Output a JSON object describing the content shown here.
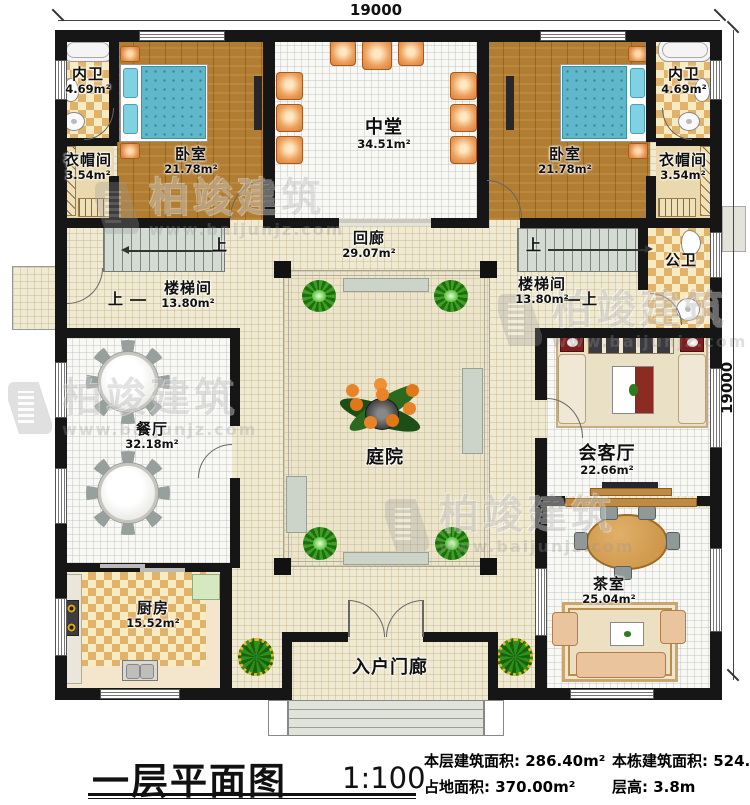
{
  "dimensions": {
    "top": "19000",
    "right": "19000"
  },
  "watermark": {
    "brand": "柏竣建筑",
    "url": "www.baijunjz.com"
  },
  "stairs": {
    "up_label": "上"
  },
  "rooms": {
    "neiwei_left": {
      "name": "内卫",
      "area": "4.69m²"
    },
    "yimaojian_left": {
      "name": "衣帽间",
      "area": "3.54m²"
    },
    "woshi_left": {
      "name": "卧室",
      "area": "21.78m²"
    },
    "zhongtang": {
      "name": "中堂",
      "area": "34.51m²"
    },
    "woshi_right": {
      "name": "卧室",
      "area": "21.78m²"
    },
    "neiwei_right": {
      "name": "内卫",
      "area": "4.69m²"
    },
    "yimaojian_right": {
      "name": "衣帽间",
      "area": "3.54m²"
    },
    "huilang": {
      "name": "回廊",
      "area": "29.07m²"
    },
    "loutijian_left": {
      "name": "楼梯间",
      "area": "13.80m²"
    },
    "loutijian_right": {
      "name": "楼梯间",
      "area": "13.80m²"
    },
    "gongwei": {
      "name": "公卫"
    },
    "canting": {
      "name": "餐厅",
      "area": "32.18m²"
    },
    "tingyuan": {
      "name": "庭院"
    },
    "huiketing": {
      "name": "会客厅",
      "area": "22.66m²"
    },
    "chashi": {
      "name": "茶室",
      "area": "25.04m²"
    },
    "chufang": {
      "name": "厨房",
      "area": "15.52m²"
    },
    "ruhumenlang": {
      "name": "入户门廊"
    }
  },
  "titleblock": {
    "title": "一层平面图",
    "scale": "1:100",
    "stats": [
      {
        "label": "本层建筑面积:",
        "value": "286.40m²"
      },
      {
        "label": "占地面积:",
        "value": "370.00m²"
      },
      {
        "label": "本栋建筑面积:",
        "value": "524.28m²"
      },
      {
        "label": "层高:",
        "value": "3.8m"
      }
    ]
  }
}
